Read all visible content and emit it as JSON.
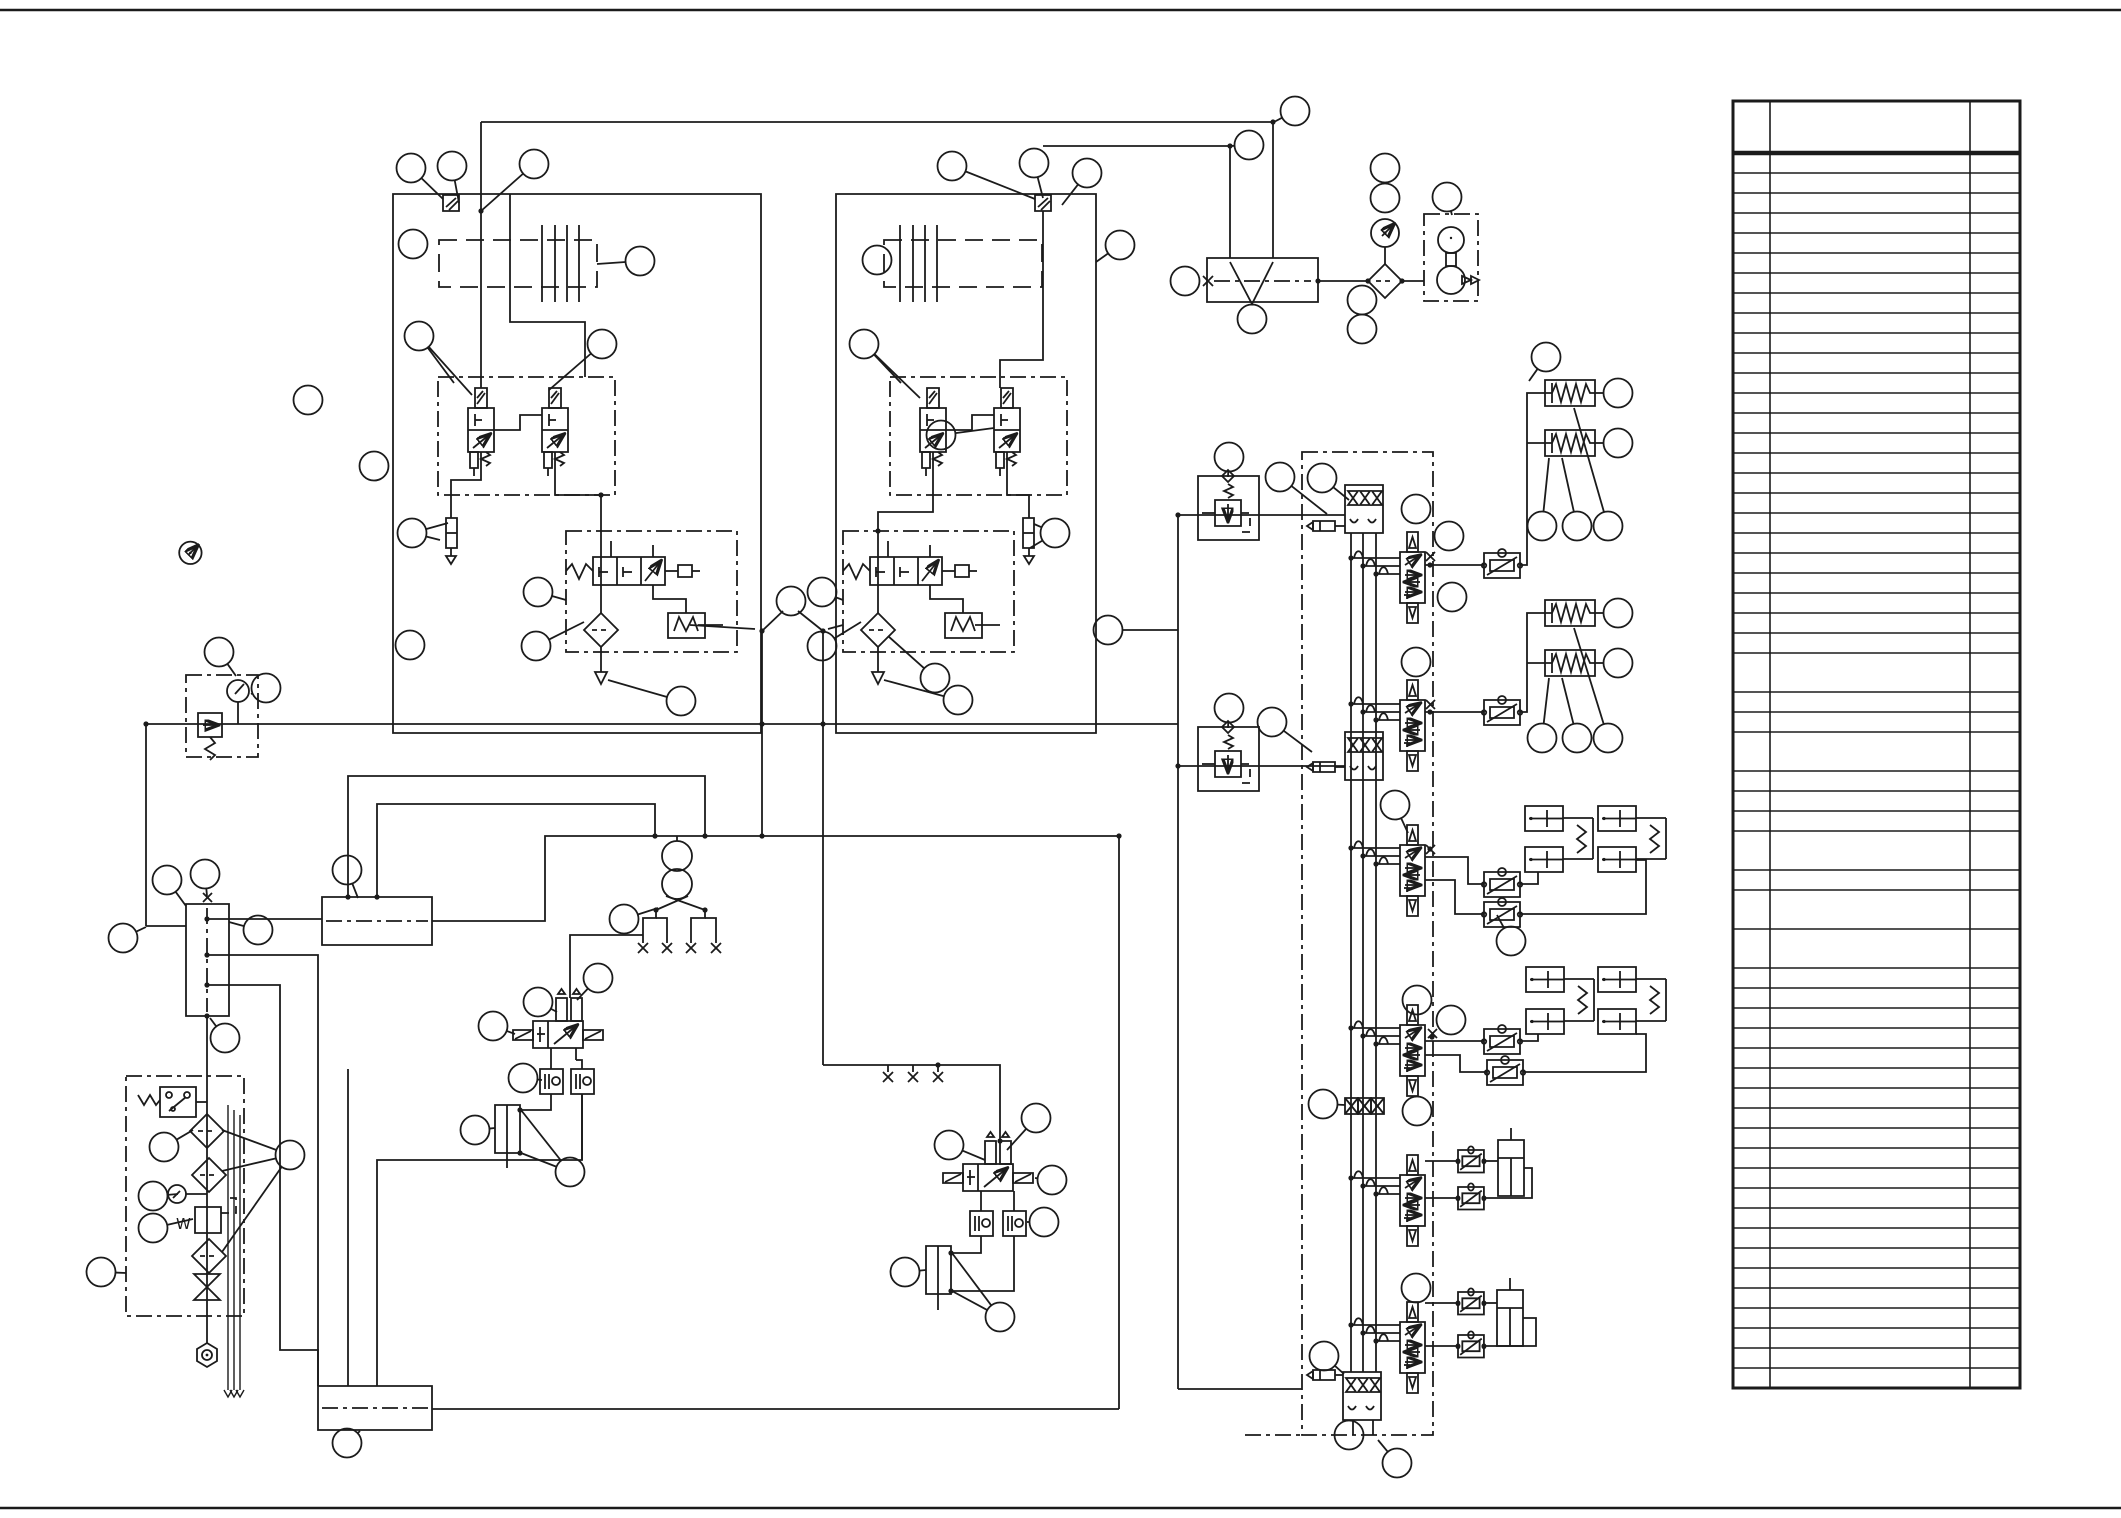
{
  "page": {
    "width": 2121,
    "height": 1518,
    "background": "#ffffff",
    "ink_color": "#1b1b1b"
  },
  "labels": {
    "pump_unit_water_mark": "W"
  },
  "parts_table": {
    "x": 1733,
    "y": 101,
    "right": 2020,
    "col1_x": 1770,
    "col2_x": 1970,
    "header_h": 52,
    "row_h": 20,
    "tall_h": 39,
    "rows": 57,
    "tall_rows": [
      25,
      28,
      32,
      34,
      35
    ]
  },
  "components": [
    "pump-assembly-1",
    "pump-assembly-2",
    "engine-block",
    "pilot-valve",
    "pump-regulator",
    "fan-motor-unit",
    "gear-manifold",
    "pressure-gauge",
    "filter",
    "pilot-relief-assembly",
    "control-valve-bank",
    "spool-section",
    "anti-cavitation-block",
    "flow-control-valve",
    "spring-brake-actuator",
    "brake-cylinder-pair",
    "cylinder",
    "solenoid-valve-assembly",
    "check-valve-block",
    "hand-pump",
    "quick-coupler",
    "suction-manifold",
    "return-manifold",
    "pump-unit-filters",
    "shutoff-valve",
    "pressure-switch",
    "drain-plug",
    "callout-balloon"
  ],
  "callouts": [
    {
      "x": 411,
      "y": 168,
      "l": [
        [
          443,
          199
        ]
      ]
    },
    {
      "x": 452,
      "y": 166,
      "l": [
        [
          459,
          203
        ]
      ]
    },
    {
      "x": 534,
      "y": 164,
      "l": [
        [
          481,
          211
        ]
      ]
    },
    {
      "x": 413,
      "y": 244,
      "l": []
    },
    {
      "x": 419,
      "y": 336,
      "l": [
        [
          454,
          383
        ],
        [
          472,
          395
        ]
      ]
    },
    {
      "x": 640,
      "y": 261,
      "l": [
        [
          597,
          264
        ]
      ]
    },
    {
      "x": 602,
      "y": 344,
      "l": [
        [
          549,
          390
        ]
      ]
    },
    {
      "x": 308,
      "y": 400,
      "l": []
    },
    {
      "x": 374,
      "y": 466,
      "l": []
    },
    {
      "x": 412,
      "y": 533,
      "l": [
        [
          440,
          540
        ],
        [
          448,
          523
        ]
      ]
    },
    {
      "x": 410,
      "y": 645,
      "l": []
    },
    {
      "x": 538,
      "y": 592,
      "l": [
        [
          566,
          600
        ]
      ]
    },
    {
      "x": 536,
      "y": 646,
      "l": [
        [
          584,
          622
        ]
      ]
    },
    {
      "x": 681,
      "y": 701,
      "l": [
        [
          608,
          680
        ]
      ]
    },
    {
      "x": 877,
      "y": 260,
      "l": []
    },
    {
      "x": 864,
      "y": 344,
      "l": [
        [
          901,
          383
        ],
        [
          920,
          398
        ]
      ]
    },
    {
      "x": 952,
      "y": 166,
      "l": [
        [
          1035,
          199
        ]
      ]
    },
    {
      "x": 1034,
      "y": 163,
      "l": [
        [
          1043,
          198
        ]
      ]
    },
    {
      "x": 1087,
      "y": 173,
      "l": [
        [
          1062,
          205
        ]
      ]
    },
    {
      "x": 1120,
      "y": 245,
      "l": [
        [
          1096,
          262
        ]
      ]
    },
    {
      "x": 1055,
      "y": 533,
      "l": [
        [
          1034,
          524
        ],
        [
          1030,
          548
        ]
      ]
    },
    {
      "x": 941,
      "y": 435,
      "l": [
        [
          994,
          428
        ]
      ]
    },
    {
      "x": 822,
      "y": 592,
      "l": [
        [
          843,
          600
        ]
      ]
    },
    {
      "x": 822,
      "y": 646,
      "l": [
        [
          861,
          622
        ]
      ]
    },
    {
      "x": 935,
      "y": 678,
      "l": [
        [
          888,
          636
        ]
      ]
    },
    {
      "x": 958,
      "y": 700,
      "l": [
        [
          884,
          680
        ]
      ]
    },
    {
      "x": 791,
      "y": 601,
      "l": []
    },
    {
      "x": 1295,
      "y": 111,
      "l": [
        [
          1274,
          122
        ]
      ]
    },
    {
      "x": 1249,
      "y": 145,
      "l": [
        [
          1231,
          146
        ]
      ]
    },
    {
      "x": 1185,
      "y": 281,
      "l": [
        [
          1200,
          281
        ]
      ]
    },
    {
      "x": 1252,
      "y": 319,
      "l": []
    },
    {
      "x": 1385,
      "y": 168,
      "l": []
    },
    {
      "x": 1385,
      "y": 198,
      "l": []
    },
    {
      "x": 1362,
      "y": 300,
      "l": []
    },
    {
      "x": 1362,
      "y": 329,
      "l": []
    },
    {
      "x": 1447,
      "y": 197,
      "l": [
        [
          1452,
          215
        ]
      ]
    },
    {
      "x": 1546,
      "y": 357,
      "l": [
        [
          1529,
          381
        ]
      ]
    },
    {
      "x": 219,
      "y": 652,
      "l": [
        [
          236,
          676
        ]
      ]
    },
    {
      "x": 266,
      "y": 688,
      "l": [
        [
          251,
          694
        ]
      ]
    },
    {
      "x": 205,
      "y": 874,
      "l": [
        [
          207,
          896
        ]
      ]
    },
    {
      "x": 167,
      "y": 880,
      "l": [
        [
          186,
          906
        ]
      ]
    },
    {
      "x": 258,
      "y": 930,
      "l": [
        [
          229,
          922
        ]
      ]
    },
    {
      "x": 123,
      "y": 938,
      "l": [
        [
          146,
          927
        ]
      ]
    },
    {
      "x": 225,
      "y": 1038,
      "l": [
        [
          210,
          1018
        ]
      ]
    },
    {
      "x": 164,
      "y": 1147,
      "l": [
        [
          193,
          1130
        ]
      ]
    },
    {
      "x": 153,
      "y": 1196,
      "l": [
        [
          178,
          1194
        ]
      ]
    },
    {
      "x": 153,
      "y": 1228,
      "l": [
        [
          193,
          1219
        ]
      ]
    },
    {
      "x": 101,
      "y": 1272,
      "l": [
        [
          126,
          1273
        ]
      ]
    },
    {
      "x": 290,
      "y": 1155,
      "l": [
        [
          222,
          1130
        ],
        [
          222,
          1171
        ],
        [
          222,
          1252
        ]
      ]
    },
    {
      "x": 347,
      "y": 870,
      "l": [
        [
          358,
          898
        ]
      ]
    },
    {
      "x": 624,
      "y": 919,
      "l": [
        [
          658,
          908
        ]
      ]
    },
    {
      "x": 598,
      "y": 978,
      "l": [
        [
          577,
          1000
        ]
      ]
    },
    {
      "x": 538,
      "y": 1002,
      "l": [
        [
          557,
          1012
        ]
      ]
    },
    {
      "x": 493,
      "y": 1026,
      "l": [
        [
          515,
          1034
        ]
      ]
    },
    {
      "x": 523,
      "y": 1078,
      "l": [
        [
          542,
          1080
        ]
      ]
    },
    {
      "x": 475,
      "y": 1130,
      "l": [
        [
          495,
          1128
        ]
      ]
    },
    {
      "x": 570,
      "y": 1172,
      "l": [
        [
          521,
          1110
        ],
        [
          521,
          1153
        ]
      ]
    },
    {
      "x": 949,
      "y": 1145,
      "l": [
        [
          985,
          1160
        ]
      ]
    },
    {
      "x": 1036,
      "y": 1118,
      "l": [
        [
          1007,
          1150
        ]
      ]
    },
    {
      "x": 1052,
      "y": 1180,
      "l": [
        [
          1035,
          1178
        ]
      ]
    },
    {
      "x": 1044,
      "y": 1222,
      "l": [
        [
          1027,
          1222
        ]
      ]
    },
    {
      "x": 905,
      "y": 1272,
      "l": [
        [
          926,
          1270
        ]
      ]
    },
    {
      "x": 1000,
      "y": 1317,
      "l": [
        [
          952,
          1253
        ],
        [
          952,
          1291
        ]
      ]
    },
    {
      "x": 1229,
      "y": 457,
      "l": [
        [
          1228,
          477
        ]
      ]
    },
    {
      "x": 1280,
      "y": 477,
      "l": [
        [
          1327,
          514
        ]
      ]
    },
    {
      "x": 1108,
      "y": 630,
      "l": [
        [
          1178,
          630
        ]
      ]
    },
    {
      "x": 1322,
      "y": 478,
      "l": [
        [
          1349,
          500
        ]
      ]
    },
    {
      "x": 1416,
      "y": 509,
      "l": []
    },
    {
      "x": 1449,
      "y": 536,
      "l": []
    },
    {
      "x": 1452,
      "y": 597,
      "l": []
    },
    {
      "x": 1618,
      "y": 393,
      "l": []
    },
    {
      "x": 1618,
      "y": 443,
      "l": []
    },
    {
      "x": 1542,
      "y": 526,
      "l": [
        [
          1549,
          458
        ]
      ]
    },
    {
      "x": 1577,
      "y": 526,
      "l": [
        [
          1562,
          458
        ]
      ]
    },
    {
      "x": 1608,
      "y": 526,
      "l": [
        [
          1574,
          408
        ]
      ]
    },
    {
      "x": 1229,
      "y": 708,
      "l": [
        [
          1228,
          728
        ]
      ]
    },
    {
      "x": 1272,
      "y": 722,
      "l": [
        [
          1312,
          752
        ]
      ]
    },
    {
      "x": 1416,
      "y": 662,
      "l": []
    },
    {
      "x": 1618,
      "y": 613,
      "l": []
    },
    {
      "x": 1618,
      "y": 663,
      "l": []
    },
    {
      "x": 1542,
      "y": 738,
      "l": [
        [
          1549,
          678
        ]
      ]
    },
    {
      "x": 1577,
      "y": 738,
      "l": [
        [
          1562,
          678
        ]
      ]
    },
    {
      "x": 1608,
      "y": 738,
      "l": [
        [
          1574,
          628
        ]
      ]
    },
    {
      "x": 1395,
      "y": 805,
      "l": [
        [
          1408,
          833
        ]
      ]
    },
    {
      "x": 1511,
      "y": 941,
      "l": [
        [
          1497,
          915
        ]
      ]
    },
    {
      "x": 1417,
      "y": 1000,
      "l": [
        [
          1410,
          1013
        ]
      ]
    },
    {
      "x": 1451,
      "y": 1020,
      "l": []
    },
    {
      "x": 1323,
      "y": 1104,
      "l": [
        [
          1345,
          1105
        ]
      ]
    },
    {
      "x": 1417,
      "y": 1111,
      "l": []
    },
    {
      "x": 1416,
      "y": 1288,
      "l": []
    },
    {
      "x": 1324,
      "y": 1356,
      "l": [
        [
          1344,
          1374
        ]
      ]
    },
    {
      "x": 1349,
      "y": 1435,
      "l": []
    },
    {
      "x": 1397,
      "y": 1463,
      "l": [
        [
          1378,
          1440
        ]
      ]
    },
    {
      "x": 347,
      "y": 1443,
      "l": [
        [
          360,
          1431
        ]
      ]
    }
  ],
  "junction_dots": [
    [
      481,
      211
    ],
    [
      762,
      631
    ],
    [
      823,
      631
    ],
    [
      762,
      724
    ],
    [
      823,
      724
    ],
    [
      762,
      836
    ],
    [
      705,
      836
    ],
    [
      655,
      836
    ],
    [
      1119,
      836
    ],
    [
      938,
      1065
    ],
    [
      656,
      910
    ],
    [
      705,
      910
    ],
    [
      348,
      897
    ],
    [
      377,
      897
    ],
    [
      207,
      919
    ],
    [
      207,
      955
    ],
    [
      207,
      985
    ],
    [
      1178,
      515
    ],
    [
      1178,
      766
    ],
    [
      1351,
      558
    ],
    [
      1363,
      566
    ],
    [
      1376,
      574
    ],
    [
      1351,
      704
    ],
    [
      1363,
      712
    ],
    [
      1376,
      720
    ],
    [
      1351,
      848
    ],
    [
      1363,
      856
    ],
    [
      1376,
      864
    ],
    [
      1351,
      1028
    ],
    [
      1363,
      1036
    ],
    [
      1376,
      1044
    ],
    [
      1351,
      1178
    ],
    [
      1363,
      1186
    ],
    [
      1376,
      1194
    ],
    [
      1351,
      1325
    ],
    [
      1363,
      1333
    ],
    [
      1376,
      1341
    ],
    [
      520,
      1110
    ],
    [
      520,
      1153
    ],
    [
      951,
      1253
    ],
    [
      951,
      1291
    ],
    [
      1273,
      122
    ],
    [
      1230,
      146
    ],
    [
      1430,
      565
    ],
    [
      1430,
      712
    ],
    [
      1430,
      849
    ],
    [
      1432,
      1037
    ],
    [
      601,
      495
    ],
    [
      878,
      531
    ],
    [
      1000,
      1141
    ],
    [
      207,
      1016
    ],
    [
      146,
      724
    ],
    [
      1318,
      281
    ],
    [
      1368,
      281
    ],
    [
      1402,
      281
    ]
  ]
}
